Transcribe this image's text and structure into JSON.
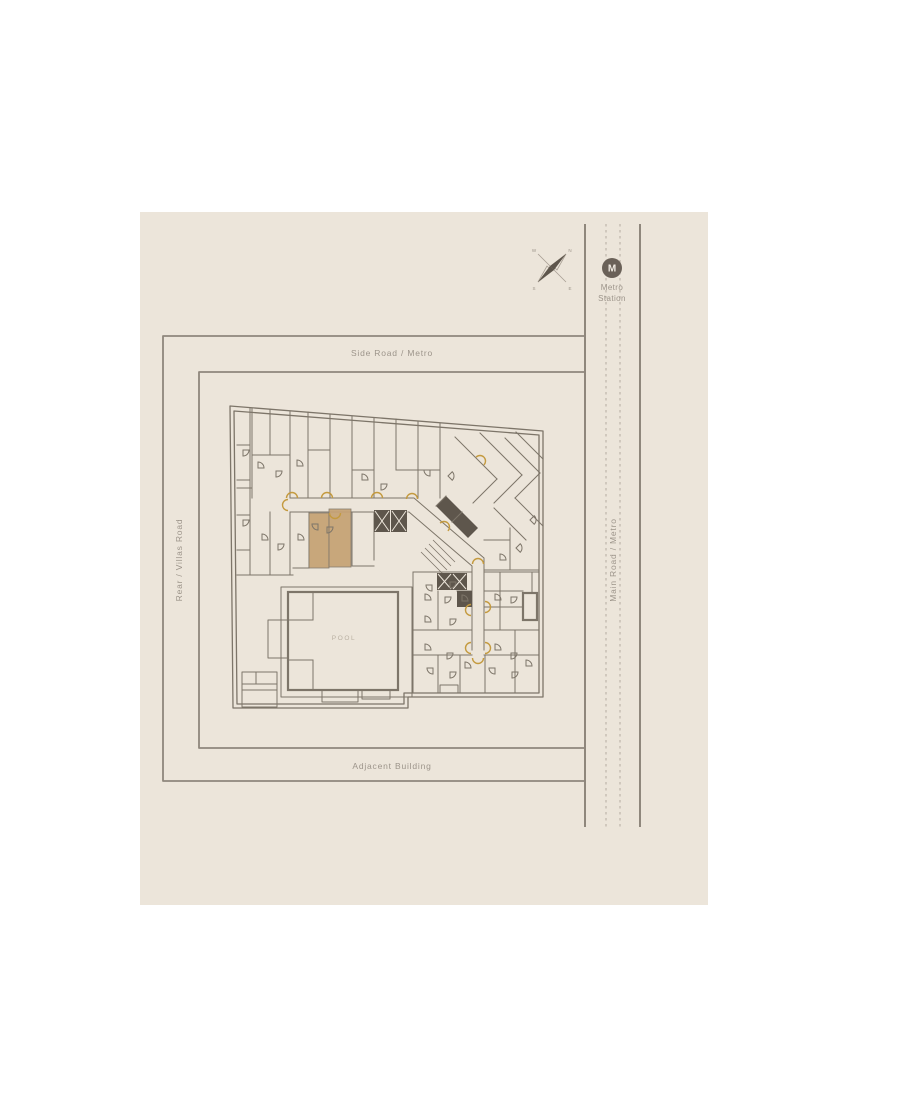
{
  "colors": {
    "page_bg": "#ffffff",
    "panel_bg": "#ece5da",
    "road_line": "#8f877c",
    "rail_dash": "#b9b1a6",
    "wall": "#7d7569",
    "wall_dark": "#5e564c",
    "gold": "#c49a3f",
    "unit_fill": "#c5a274",
    "label_text": "#9c948a",
    "pool_text": "#b9b0a2",
    "metro_badge": "#6a6158",
    "m_text": "#f1ece3"
  },
  "labels": {
    "side_road": "Side Road / Metro",
    "rear_road": "Rear / Villas Road",
    "main_road": "Main Road / Metro",
    "adjacent": "Adjacent Building",
    "pool": "POOL"
  },
  "metro_station": {
    "symbol": "M",
    "line1": "Metro",
    "line2": "Station"
  },
  "compass": {
    "north": "N",
    "east": "E",
    "south": "S",
    "west": "W"
  }
}
